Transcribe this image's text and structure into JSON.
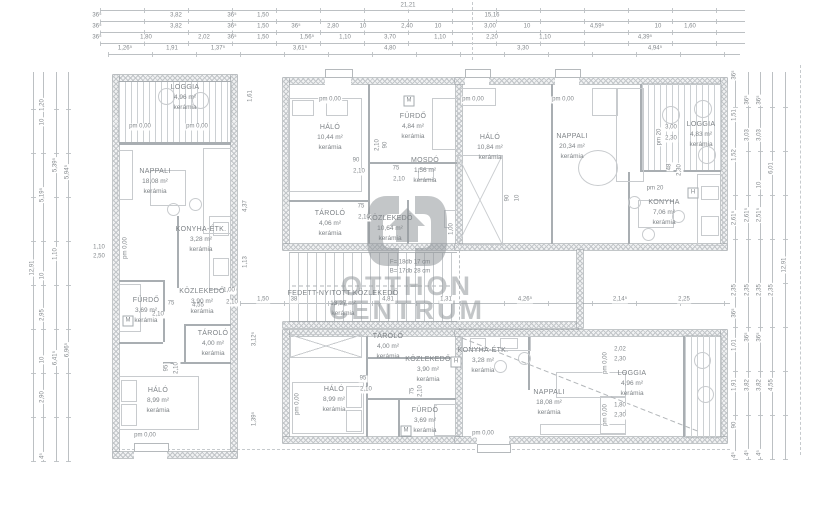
{
  "watermark": {
    "line1": "OTTHON",
    "line2": "CENTRUM"
  },
  "dims": {
    "top": [
      {
        "t": "21,21",
        "x": 408,
        "y": 6
      },
      {
        "t": "36⁵",
        "x": 97,
        "y": 16
      },
      {
        "t": "3,82",
        "x": 176,
        "y": 16
      },
      {
        "t": "36⁵",
        "x": 232,
        "y": 16
      },
      {
        "t": "1,50",
        "x": 263,
        "y": 16
      },
      {
        "t": "15,16",
        "x": 492,
        "y": 16
      },
      {
        "t": "36⁵",
        "x": 97,
        "y": 27
      },
      {
        "t": "3,82",
        "x": 176,
        "y": 27
      },
      {
        "t": "36⁵",
        "x": 232,
        "y": 27
      },
      {
        "t": "1,50",
        "x": 263,
        "y": 27
      },
      {
        "t": "36⁵",
        "x": 296,
        "y": 27
      },
      {
        "t": "2,80",
        "x": 333,
        "y": 27
      },
      {
        "t": "10",
        "x": 363,
        "y": 27
      },
      {
        "t": "2,40",
        "x": 407,
        "y": 27
      },
      {
        "t": "10",
        "x": 438,
        "y": 27
      },
      {
        "t": "3,00",
        "x": 490,
        "y": 27
      },
      {
        "t": "10",
        "x": 527,
        "y": 27
      },
      {
        "t": "4,59⁵",
        "x": 597,
        "y": 27
      },
      {
        "t": "10",
        "x": 658,
        "y": 27
      },
      {
        "t": "1,60",
        "x": 690,
        "y": 27
      },
      {
        "t": "36⁵",
        "x": 97,
        "y": 38
      },
      {
        "t": "1,80",
        "x": 146,
        "y": 38
      },
      {
        "t": "2,02",
        "x": 204,
        "y": 38
      },
      {
        "t": "36⁵",
        "x": 232,
        "y": 38
      },
      {
        "t": "1,50",
        "x": 263,
        "y": 38
      },
      {
        "t": "1,56⁵",
        "x": 307,
        "y": 38
      },
      {
        "t": "1,10",
        "x": 345,
        "y": 38
      },
      {
        "t": "3,70",
        "x": 390,
        "y": 38
      },
      {
        "t": "1,10",
        "x": 440,
        "y": 38
      },
      {
        "t": "2,20",
        "x": 492,
        "y": 38
      },
      {
        "t": "1,10",
        "x": 545,
        "y": 38
      },
      {
        "t": "4,39⁵",
        "x": 645,
        "y": 38
      },
      {
        "t": "1,26⁵",
        "x": 125,
        "y": 49
      },
      {
        "t": "1,91",
        "x": 172,
        "y": 49
      },
      {
        "t": "1,37⁵",
        "x": 218,
        "y": 49
      },
      {
        "t": "3,61⁵",
        "x": 300,
        "y": 49
      },
      {
        "t": "4,80",
        "x": 390,
        "y": 49
      },
      {
        "t": "3,30",
        "x": 523,
        "y": 49
      },
      {
        "t": "4,94⁵",
        "x": 655,
        "y": 49
      }
    ],
    "left": [
      {
        "t": "12,91",
        "x": 33,
        "y": 268,
        "r": 1
      },
      {
        "t": "1,20",
        "x": 43,
        "y": 105,
        "r": 1
      },
      {
        "t": "10",
        "x": 43,
        "y": 122,
        "r": 1
      },
      {
        "t": "5,19⁵",
        "x": 43,
        "y": 195,
        "r": 1
      },
      {
        "t": "10",
        "x": 43,
        "y": 276,
        "r": 1
      },
      {
        "t": "2,95",
        "x": 43,
        "y": 315,
        "r": 1
      },
      {
        "t": "10",
        "x": 43,
        "y": 360,
        "r": 1
      },
      {
        "t": "2,90",
        "x": 43,
        "y": 397,
        "r": 1
      },
      {
        "t": "4⁵",
        "x": 43,
        "y": 456,
        "r": 1
      },
      {
        "t": "5,39⁵",
        "x": 56,
        "y": 165,
        "r": 1
      },
      {
        "t": "1,10",
        "x": 56,
        "y": 254,
        "r": 1
      },
      {
        "t": "6,41⁵",
        "x": 56,
        "y": 358,
        "r": 1
      },
      {
        "t": "5,94⁵",
        "x": 68,
        "y": 172,
        "r": 1
      },
      {
        "t": "6,96⁵",
        "x": 68,
        "y": 350,
        "r": 1
      }
    ],
    "right": [
      {
        "t": "36⁵",
        "x": 735,
        "y": 75,
        "r": 1
      },
      {
        "t": "1,51",
        "x": 735,
        "y": 115,
        "r": 1
      },
      {
        "t": "1,52",
        "x": 735,
        "y": 155,
        "r": 1
      },
      {
        "t": "2,61⁵",
        "x": 735,
        "y": 218,
        "r": 1
      },
      {
        "t": "2,35",
        "x": 735,
        "y": 290,
        "r": 1
      },
      {
        "t": "36⁵",
        "x": 735,
        "y": 313,
        "r": 1
      },
      {
        "t": "1,01",
        "x": 735,
        "y": 345,
        "r": 1
      },
      {
        "t": "1,91",
        "x": 735,
        "y": 385,
        "r": 1
      },
      {
        "t": "90",
        "x": 735,
        "y": 425,
        "r": 1
      },
      {
        "t": "4⁵",
        "x": 735,
        "y": 455,
        "r": 1
      },
      {
        "t": "36⁵",
        "x": 748,
        "y": 100,
        "r": 1
      },
      {
        "t": "3,03",
        "x": 748,
        "y": 135,
        "r": 1
      },
      {
        "t": "2,61⁵",
        "x": 748,
        "y": 215,
        "r": 1
      },
      {
        "t": "2,35",
        "x": 748,
        "y": 290,
        "r": 1
      },
      {
        "t": "36⁵",
        "x": 748,
        "y": 337,
        "r": 1
      },
      {
        "t": "3,82",
        "x": 748,
        "y": 385,
        "r": 1
      },
      {
        "t": "4⁵",
        "x": 748,
        "y": 453,
        "r": 1
      },
      {
        "t": "36⁵",
        "x": 760,
        "y": 100,
        "r": 1
      },
      {
        "t": "3,03",
        "x": 760,
        "y": 135,
        "r": 1
      },
      {
        "t": "10",
        "x": 760,
        "y": 185,
        "r": 1
      },
      {
        "t": "2,51⁵",
        "x": 760,
        "y": 215,
        "r": 1
      },
      {
        "t": "2,35",
        "x": 760,
        "y": 290,
        "r": 1
      },
      {
        "t": "36⁵",
        "x": 760,
        "y": 337,
        "r": 1
      },
      {
        "t": "3,82",
        "x": 760,
        "y": 385,
        "r": 1
      },
      {
        "t": "4⁵",
        "x": 760,
        "y": 453,
        "r": 1
      },
      {
        "t": "6,01",
        "x": 772,
        "y": 168,
        "r": 1
      },
      {
        "t": "2,35",
        "x": 772,
        "y": 290,
        "r": 1
      },
      {
        "t": "4,55",
        "x": 772,
        "y": 385,
        "r": 1
      },
      {
        "t": "12,91",
        "x": 785,
        "y": 265,
        "r": 1
      }
    ],
    "mid": [
      {
        "t": "1,50",
        "x": 263,
        "y": 300
      },
      {
        "t": "38",
        "x": 294,
        "y": 300
      },
      {
        "t": "4,81",
        "x": 388,
        "y": 300
      },
      {
        "t": "1,31",
        "x": 446,
        "y": 300
      },
      {
        "t": "4,26⁵",
        "x": 525,
        "y": 300
      },
      {
        "t": "2,14⁵",
        "x": 620,
        "y": 300
      },
      {
        "t": "2,25",
        "x": 684,
        "y": 300
      }
    ],
    "inner": [
      {
        "t": "75",
        "x": 171,
        "y": 304
      },
      {
        "t": "4,55",
        "x": 198,
        "y": 306
      },
      {
        "t": "1,00",
        "x": 229,
        "y": 291
      },
      {
        "t": "2,10",
        "x": 232,
        "y": 303
      },
      {
        "t": "2,10",
        "x": 158,
        "y": 315
      },
      {
        "t": "95",
        "x": 167,
        "y": 368,
        "r": 1
      },
      {
        "t": "2,10",
        "x": 177,
        "y": 368,
        "r": 1
      },
      {
        "t": "1,10",
        "x": 99,
        "y": 248
      },
      {
        "t": "2,50",
        "x": 99,
        "y": 257
      },
      {
        "t": "90",
        "x": 356,
        "y": 161
      },
      {
        "t": "2,10",
        "x": 359,
        "y": 172
      },
      {
        "t": "75",
        "x": 396,
        "y": 169
      },
      {
        "t": "2,10",
        "x": 399,
        "y": 180
      },
      {
        "t": "90",
        "x": 386,
        "y": 145,
        "r": 1
      },
      {
        "t": "2,10",
        "x": 378,
        "y": 145,
        "r": 1
      },
      {
        "t": "75",
        "x": 361,
        "y": 207
      },
      {
        "t": "2,10",
        "x": 364,
        "y": 218
      },
      {
        "t": "1,00",
        "x": 452,
        "y": 229,
        "r": 1
      },
      {
        "t": "90",
        "x": 508,
        "y": 198,
        "r": 1
      },
      {
        "t": "10",
        "x": 518,
        "y": 198,
        "r": 1
      },
      {
        "t": "3,00",
        "x": 671,
        "y": 128
      },
      {
        "t": "2,30",
        "x": 671,
        "y": 139
      },
      {
        "t": "48",
        "x": 670,
        "y": 167,
        "r": 1
      },
      {
        "t": "2,30",
        "x": 680,
        "y": 170,
        "r": 1
      },
      {
        "t": "95",
        "x": 363,
        "y": 379
      },
      {
        "t": "2,10",
        "x": 366,
        "y": 390
      },
      {
        "t": "75",
        "x": 413,
        "y": 391,
        "r": 1
      },
      {
        "t": "2,10",
        "x": 421,
        "y": 391,
        "r": 1
      },
      {
        "t": "2,02",
        "x": 620,
        "y": 350
      },
      {
        "t": "2,30",
        "x": 620,
        "y": 360
      },
      {
        "t": "1,80",
        "x": 620,
        "y": 406
      },
      {
        "t": "2,30",
        "x": 620,
        "y": 416
      },
      {
        "t": "1,61",
        "x": 251,
        "y": 96,
        "r": 1
      },
      {
        "t": "4,37",
        "x": 246,
        "y": 206,
        "r": 1
      },
      {
        "t": "1,13",
        "x": 246,
        "y": 262,
        "r": 1
      },
      {
        "t": "3,12⁵",
        "x": 255,
        "y": 339,
        "r": 1
      },
      {
        "t": "1,39⁵",
        "x": 255,
        "y": 419,
        "r": 1
      }
    ]
  },
  "levels": [
    {
      "t": "pm 0,00",
      "x": 140,
      "y": 127
    },
    {
      "t": "pm 0,00",
      "x": 197,
      "y": 127
    },
    {
      "t": "pm 0,00",
      "x": 126,
      "y": 248,
      "r": 1
    },
    {
      "t": "pm 0,00",
      "x": 330,
      "y": 100
    },
    {
      "t": "pm 0,00",
      "x": 473,
      "y": 100
    },
    {
      "t": "pm 0,00",
      "x": 563,
      "y": 100
    },
    {
      "t": "pm 20",
      "x": 660,
      "y": 137,
      "r": 1
    },
    {
      "t": "pm 20",
      "x": 655,
      "y": 189
    },
    {
      "t": "pm 0,00",
      "x": 145,
      "y": 436
    },
    {
      "t": "pm 0,00",
      "x": 298,
      "y": 404,
      "r": 1
    },
    {
      "t": "pm 0,00",
      "x": 483,
      "y": 434
    },
    {
      "t": "pm 0,00",
      "x": 606,
      "y": 363,
      "r": 1
    },
    {
      "t": "pm 0,00",
      "x": 606,
      "y": 415,
      "r": 1
    }
  ],
  "rooms": [
    {
      "name": "LOGGIA",
      "area": "4,96 m²",
      "finish": "kerámia",
      "x": 185,
      "y": 84
    },
    {
      "name": "NAPPALI",
      "area": "18,08 m²",
      "finish": "kerámia",
      "x": 155,
      "y": 168
    },
    {
      "name": "KONYHA-ÉTK.",
      "area": "3,28 m²",
      "finish": "kerámia",
      "x": 201,
      "y": 226
    },
    {
      "name": "KÖZLEKEDŐ",
      "area": "3,90 m²",
      "finish": "kerámia",
      "x": 202,
      "y": 288
    },
    {
      "name": "FÜRDŐ",
      "area": "3,69 m²",
      "finish": "kerámia",
      "x": 146,
      "y": 297
    },
    {
      "name": "TÁROLÓ",
      "area": "4,00 m²",
      "finish": "kerámia",
      "x": 213,
      "y": 330
    },
    {
      "name": "HÁLÓ",
      "area": "8,99 m²",
      "finish": "kerámia",
      "x": 158,
      "y": 387
    },
    {
      "name": "HÁLÓ",
      "area": "10,44 m²",
      "finish": "kerámia",
      "x": 330,
      "y": 124
    },
    {
      "name": "FÜRDŐ",
      "area": "4,84 m²",
      "finish": "kerámia",
      "x": 413,
      "y": 113
    },
    {
      "name": "MOSDÓ",
      "area": "1,56 m²",
      "finish": "kerámia",
      "x": 425,
      "y": 157
    },
    {
      "name": "TÁROLÓ",
      "area": "4,06 m²",
      "finish": "kerámia",
      "x": 330,
      "y": 210
    },
    {
      "name": "KÖZLEKEDŐ",
      "area": "10,64 m²",
      "finish": "kerámia",
      "x": 390,
      "y": 215
    },
    {
      "name": "FEDETT-NYITOTT KÖZLEKEDŐ",
      "area": "13,27 m²",
      "finish": "kerámia",
      "x": 343,
      "y": 290
    },
    {
      "name": "HÁLÓ",
      "area": "10,84 m²",
      "finish": "kerámia",
      "x": 490,
      "y": 134
    },
    {
      "name": "NAPPALI",
      "area": "20,34 m²",
      "finish": "kerámia",
      "x": 572,
      "y": 133
    },
    {
      "name": "KONYHA",
      "area": "7,06 m²",
      "finish": "kerámia",
      "x": 664,
      "y": 199
    },
    {
      "name": "LOGGIA",
      "area": "4,83 m²",
      "finish": "kerámia",
      "x": 701,
      "y": 121
    },
    {
      "name": "TÁROLÓ",
      "area": "4,00 m²",
      "finish": "kerámia",
      "x": 388,
      "y": 333
    },
    {
      "name": "KÖZLEKEDŐ",
      "area": "3,90 m²",
      "finish": "kerámia",
      "x": 428,
      "y": 356
    },
    {
      "name": "HÁLÓ",
      "area": "8,99 m²",
      "finish": "kerámia",
      "x": 334,
      "y": 386
    },
    {
      "name": "FÜRDŐ",
      "area": "3,69 m²",
      "finish": "kerámia",
      "x": 425,
      "y": 407
    },
    {
      "name": "KONYHA-ÉTK.",
      "area": "3,28 m²",
      "finish": "kerámia",
      "x": 483,
      "y": 347
    },
    {
      "name": "NAPPALI",
      "area": "18,08 m²",
      "finish": "kerámia",
      "x": 549,
      "y": 389
    },
    {
      "name": "LOGGIA",
      "area": "4,96 m²",
      "finish": "kerámia",
      "x": 632,
      "y": 370
    }
  ],
  "notes": [
    {
      "t": "F= 18db 17 cm",
      "x": 410,
      "y": 263
    },
    {
      "t": "B= 17db 28 cm",
      "x": 410,
      "y": 272
    }
  ],
  "symbols": [
    {
      "t": "M",
      "x": 128,
      "y": 321
    },
    {
      "t": "M",
      "x": 409,
      "y": 101
    },
    {
      "t": "M",
      "x": 406,
      "y": 431
    },
    {
      "t": "H",
      "x": 456,
      "y": 362
    },
    {
      "t": "H",
      "x": 693,
      "y": 193
    }
  ]
}
